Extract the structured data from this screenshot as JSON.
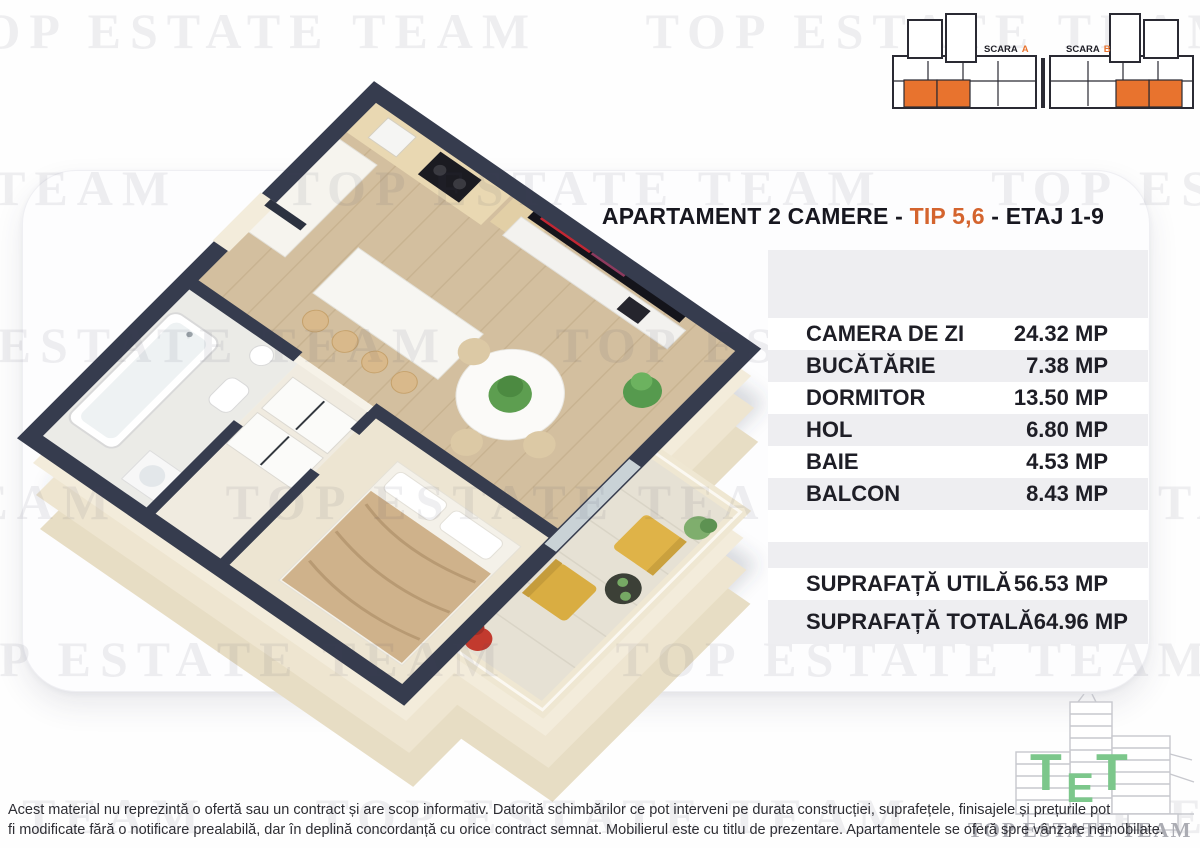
{
  "title": {
    "part1": "APARTAMENT 2 CAMERE - ",
    "highlight": "TIP 5,6",
    "part2": " - ETAJ 1-9"
  },
  "schematic": {
    "scara_a": {
      "label": "SCARA",
      "letter": "A"
    },
    "scara_b": {
      "label": "SCARA",
      "letter": "B"
    }
  },
  "rooms": [
    {
      "label": "CAMERA DE ZI",
      "value": "24.32 MP"
    },
    {
      "label": "BUCĂTĂRIE",
      "value": "7.38 MP"
    },
    {
      "label": "DORMITOR",
      "value": "13.50 MP"
    },
    {
      "label": "HOL",
      "value": "6.80 MP"
    },
    {
      "label": "BAIE",
      "value": "4.53 MP"
    },
    {
      "label": "BALCON",
      "value": "8.43 MP"
    }
  ],
  "totals": [
    {
      "label": "SUPRAFAȚĂ UTILĂ",
      "value": "56.53 MP"
    },
    {
      "label": "SUPRAFAȚĂ TOTALĂ",
      "value": "64.96 MP"
    }
  ],
  "watermark": {
    "text": "TOP ESTATE TEAM"
  },
  "logo": {
    "tet_letters": [
      "T",
      "E",
      "T"
    ],
    "brand": "TOP ESTATE TEAM"
  },
  "disclaimer": {
    "line1": "Acest material nu reprezintă o ofertă sau un contract și are scop informativ. Datorită schimbărilor ce pot interveni pe durata construcției, suprafețele, finisajele și prețurile pot",
    "line2": "fi modificate fără o notificare prealabilă, dar în deplină concordanță cu orice contract semnat. Mobilierul este cu titlu de prezentare. Apartamentele se oferă spre vânzare nemobilate."
  },
  "colors": {
    "accent_orange": "#d4642e",
    "unit_highlight_orange": "#e8732e",
    "wall_navy": "#363c4e",
    "wall_cream": "#efe7d3",
    "panel_gray": "#eeeef1",
    "watermark_gray": "#dcdce0",
    "logo_green": "#7cc78b"
  }
}
